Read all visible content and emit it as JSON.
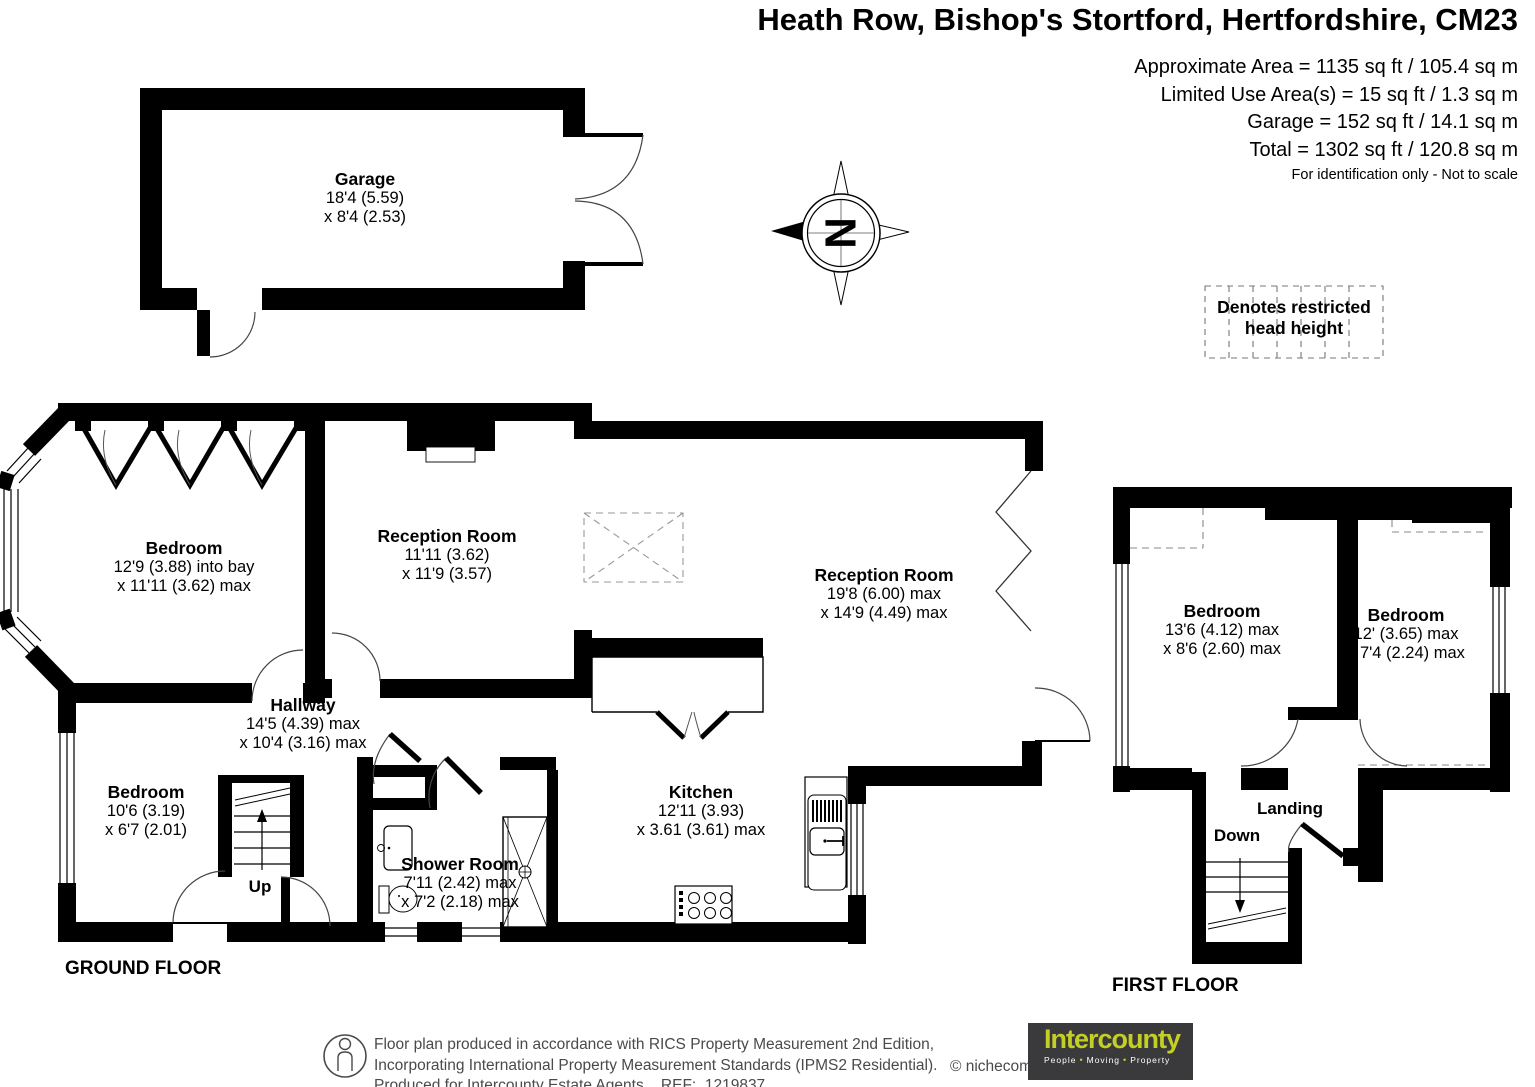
{
  "header": {
    "title": "Heath Row, Bishop's Stortford, Hertfordshire, CM23",
    "area_line1": "Approximate Area = 1135 sq ft / 105.4 sq m",
    "area_line2": "Limited Use Area(s) = 15 sq ft / 1.3 sq m",
    "area_line3": "Garage = 152 sq ft / 14.1 sq m",
    "area_line4": "Total = 1302 sq ft / 120.8 sq m",
    "disclaimer": "For identification only - Not to scale"
  },
  "legend": {
    "restricted_line1": "Denotes restricted",
    "restricted_line2": "head height"
  },
  "compass": {
    "north": "N"
  },
  "rooms": {
    "garage": {
      "name": "Garage",
      "dim1": "18'4 (5.59)",
      "dim2": "x 8'4 (2.53)"
    },
    "bedroom_bay": {
      "name": "Bedroom",
      "dim1": "12'9 (3.88) into bay",
      "dim2": "x 11'11 (3.62) max"
    },
    "reception1": {
      "name": "Reception Room",
      "dim1": "11'11 (3.62)",
      "dim2": "x 11'9 (3.57)"
    },
    "reception2": {
      "name": "Reception Room",
      "dim1": "19'8 (6.00) max",
      "dim2": "x 14'9 (4.49) max"
    },
    "hallway": {
      "name": "Hallway",
      "dim1": "14'5 (4.39) max",
      "dim2": "x 10'4 (3.16) max"
    },
    "bedroom_small": {
      "name": "Bedroom",
      "dim1": "10'6 (3.19)",
      "dim2": "x 6'7 (2.01)"
    },
    "shower": {
      "name": "Shower Room",
      "dim1": "7'11 (2.42) max",
      "dim2": "x 7'2 (2.18) max"
    },
    "kitchen": {
      "name": "Kitchen",
      "dim1": "12'11 (3.93)",
      "dim2": "x 3.61 (3.61) max"
    },
    "bedroom_ff_left": {
      "name": "Bedroom",
      "dim1": "13'6 (4.12) max",
      "dim2": "x 8'6 (2.60) max"
    },
    "bedroom_ff_right": {
      "name": "Bedroom",
      "dim1": "12' (3.65) max",
      "dim2": "x 7'4 (2.24) max"
    },
    "landing": {
      "name": "Landing"
    }
  },
  "stairs": {
    "up": "Up",
    "down": "Down"
  },
  "floor_labels": {
    "ground": "GROUND FLOOR",
    "first": "FIRST FLOOR"
  },
  "footer": {
    "line1": "Floor plan produced in accordance with RICS Property Measurement 2nd Edition,",
    "line2": "Incorporating International Property Measurement Standards (IPMS2 Residential).",
    "line3": "Produced for Intercounty Estate Agents.   REF:  1219837",
    "copyright": "© nichecom 2024.",
    "logo_brand": "Intercounty",
    "logo_word1": "People",
    "logo_word2": "Moving",
    "logo_word3": "Property",
    "logo_bullet": "•"
  }
}
